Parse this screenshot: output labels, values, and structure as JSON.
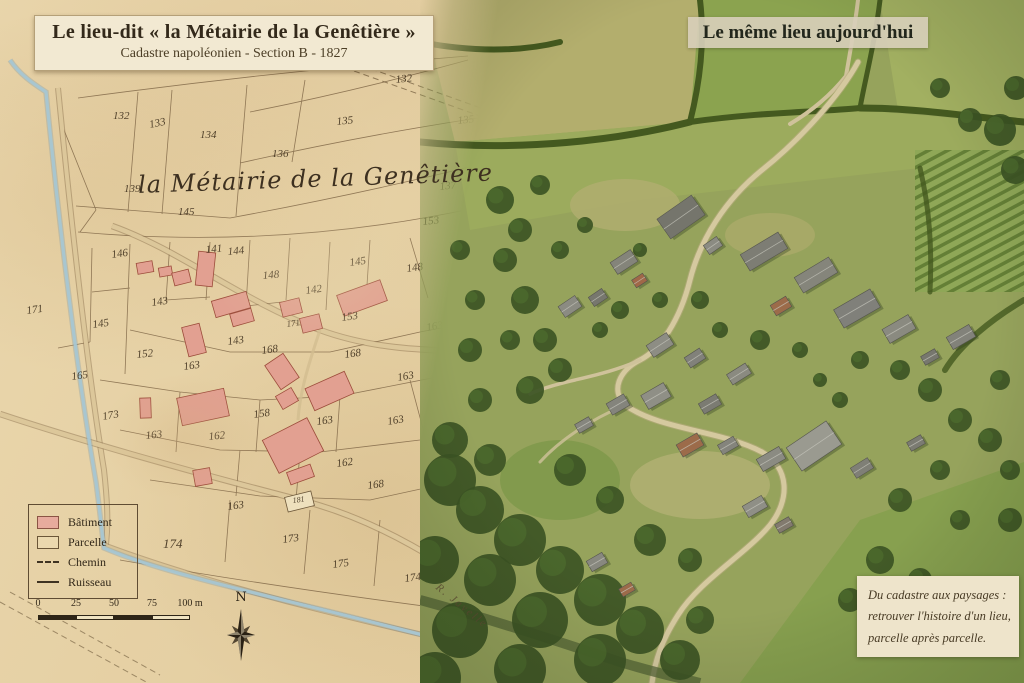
{
  "map_panel": {
    "title": "Le lieu-dit « la Métairie de la Genêtière »",
    "subtitle": "Cadastre napoléonien - Section B - 1827",
    "place_label": "la Métairie de la Genêtière",
    "stream_label": "R. Javelle",
    "compass_label": "N",
    "legend_items": [
      {
        "type": "building",
        "label": "Bâtiment"
      },
      {
        "type": "parcel",
        "label": "Parcelle"
      },
      {
        "type": "path",
        "label": "Chemin"
      },
      {
        "type": "stream",
        "label": "Ruisseau"
      }
    ],
    "scale_bar": {
      "labels": [
        "0",
        "25",
        "50",
        "75",
        "100 m"
      ],
      "segment_px": 38
    },
    "parcel_numbers": [
      {
        "n": "132",
        "x": 113,
        "y": 119
      },
      {
        "n": "132",
        "x": 396,
        "y": 83,
        "r": -6
      },
      {
        "n": "133",
        "x": 150,
        "y": 128,
        "r": -12
      },
      {
        "n": "134",
        "x": 200,
        "y": 138
      },
      {
        "n": "135",
        "x": 337,
        "y": 125,
        "r": -6
      },
      {
        "n": "135",
        "x": 458,
        "y": 124,
        "r": -6
      },
      {
        "n": "136",
        "x": 272,
        "y": 157
      },
      {
        "n": "137",
        "x": 440,
        "y": 190,
        "r": -6
      },
      {
        "n": "139",
        "x": 124,
        "y": 192
      },
      {
        "n": "145",
        "x": 178,
        "y": 215
      },
      {
        "n": "153",
        "x": 423,
        "y": 225,
        "r": -6
      },
      {
        "n": "146",
        "x": 112,
        "y": 258,
        "r": -8
      },
      {
        "n": "141",
        "x": 206,
        "y": 253,
        "r": -5
      },
      {
        "n": "144",
        "x": 228,
        "y": 255,
        "r": -5
      },
      {
        "n": "148",
        "x": 263,
        "y": 279,
        "r": -5
      },
      {
        "n": "145",
        "x": 350,
        "y": 266,
        "r": -8
      },
      {
        "n": "148",
        "x": 407,
        "y": 272,
        "r": -8
      },
      {
        "n": "142",
        "x": 306,
        "y": 294,
        "r": -8
      },
      {
        "n": "143",
        "x": 152,
        "y": 306,
        "r": -8
      },
      {
        "n": "145",
        "x": 93,
        "y": 328,
        "r": -8
      },
      {
        "n": "171",
        "x": 27,
        "y": 314,
        "r": -8
      },
      {
        "n": "163",
        "x": 448,
        "y": 301,
        "r": -10
      },
      {
        "n": "163",
        "x": 427,
        "y": 331,
        "r": -10
      },
      {
        "n": "153",
        "x": 342,
        "y": 321,
        "r": -8
      },
      {
        "n": "171",
        "x": 287,
        "y": 327,
        "r": -8,
        "s": 9
      },
      {
        "n": "143",
        "x": 228,
        "y": 345,
        "r": -8
      },
      {
        "n": "168",
        "x": 262,
        "y": 354,
        "r": -8
      },
      {
        "n": "152",
        "x": 137,
        "y": 358,
        "r": -6
      },
      {
        "n": "163",
        "x": 184,
        "y": 370,
        "r": -8
      },
      {
        "n": "168",
        "x": 345,
        "y": 358,
        "r": -8
      },
      {
        "n": "163",
        "x": 398,
        "y": 381,
        "r": -10
      },
      {
        "n": "165",
        "x": 72,
        "y": 380,
        "r": -8
      },
      {
        "n": "173",
        "x": 103,
        "y": 420,
        "r": -10
      },
      {
        "n": "158",
        "x": 254,
        "y": 418,
        "r": -8
      },
      {
        "n": "162",
        "x": 209,
        "y": 440,
        "r": -6
      },
      {
        "n": "163",
        "x": 146,
        "y": 439,
        "r": -6
      },
      {
        "n": "163",
        "x": 317,
        "y": 425,
        "r": -8
      },
      {
        "n": "163",
        "x": 388,
        "y": 425,
        "r": -10
      },
      {
        "n": "162",
        "x": 337,
        "y": 467,
        "r": -8
      },
      {
        "n": "168",
        "x": 368,
        "y": 489,
        "r": -8
      },
      {
        "n": "163",
        "x": 228,
        "y": 510,
        "r": -8
      },
      {
        "n": "181",
        "x": 293,
        "y": 503,
        "r": -8,
        "s": 8
      },
      {
        "n": "174",
        "x": 163,
        "y": 548,
        "s": 13
      },
      {
        "n": "173",
        "x": 283,
        "y": 543,
        "r": -8
      },
      {
        "n": "175",
        "x": 333,
        "y": 568,
        "r": -8
      },
      {
        "n": "174",
        "x": 405,
        "y": 582,
        "r": -8
      }
    ],
    "buildings": [
      {
        "x": 137,
        "y": 262,
        "w": 16,
        "h": 11,
        "r": -10
      },
      {
        "x": 159,
        "y": 267,
        "w": 13,
        "h": 9,
        "r": -10
      },
      {
        "x": 173,
        "y": 271,
        "w": 17,
        "h": 13,
        "r": -14
      },
      {
        "x": 197,
        "y": 252,
        "w": 17,
        "h": 34,
        "r": 6
      },
      {
        "x": 213,
        "y": 296,
        "w": 36,
        "h": 17,
        "r": -16
      },
      {
        "x": 231,
        "y": 311,
        "w": 22,
        "h": 13,
        "r": -16
      },
      {
        "x": 281,
        "y": 300,
        "w": 20,
        "h": 15,
        "r": -14
      },
      {
        "x": 301,
        "y": 316,
        "w": 20,
        "h": 15,
        "r": -14
      },
      {
        "x": 339,
        "y": 287,
        "w": 46,
        "h": 22,
        "r": -20
      },
      {
        "x": 185,
        "y": 325,
        "w": 18,
        "h": 30,
        "r": -14
      },
      {
        "x": 271,
        "y": 357,
        "w": 22,
        "h": 29,
        "r": -34
      },
      {
        "x": 140,
        "y": 398,
        "w": 11,
        "h": 20,
        "r": -2
      },
      {
        "x": 179,
        "y": 393,
        "w": 48,
        "h": 28,
        "r": -12
      },
      {
        "x": 278,
        "y": 391,
        "w": 18,
        "h": 15,
        "r": -30
      },
      {
        "x": 308,
        "y": 379,
        "w": 43,
        "h": 24,
        "r": -24
      },
      {
        "x": 268,
        "y": 427,
        "w": 50,
        "h": 37,
        "r": -27
      },
      {
        "x": 194,
        "y": 469,
        "w": 17,
        "h": 16,
        "r": -10
      },
      {
        "x": 288,
        "y": 468,
        "w": 25,
        "h": 13,
        "r": -20
      },
      {
        "x": 286,
        "y": 494,
        "w": 27,
        "h": 15,
        "r": -14,
        "open": true
      }
    ],
    "colors": {
      "parchment": "#e7d3a9",
      "building_fill": "#e2a091",
      "building_stroke": "#9c4c3b",
      "parcel_line": "#7a6142",
      "stream": "#a6c6d2",
      "road": "#dcc79a"
    }
  },
  "photo_panel": {
    "title": "Le même lieu aujourd'hui",
    "caption_lines": [
      "Du cadastre aux paysages :",
      "retrouver l'histoire d'un lieu,",
      "parcelle après parcelle."
    ]
  }
}
